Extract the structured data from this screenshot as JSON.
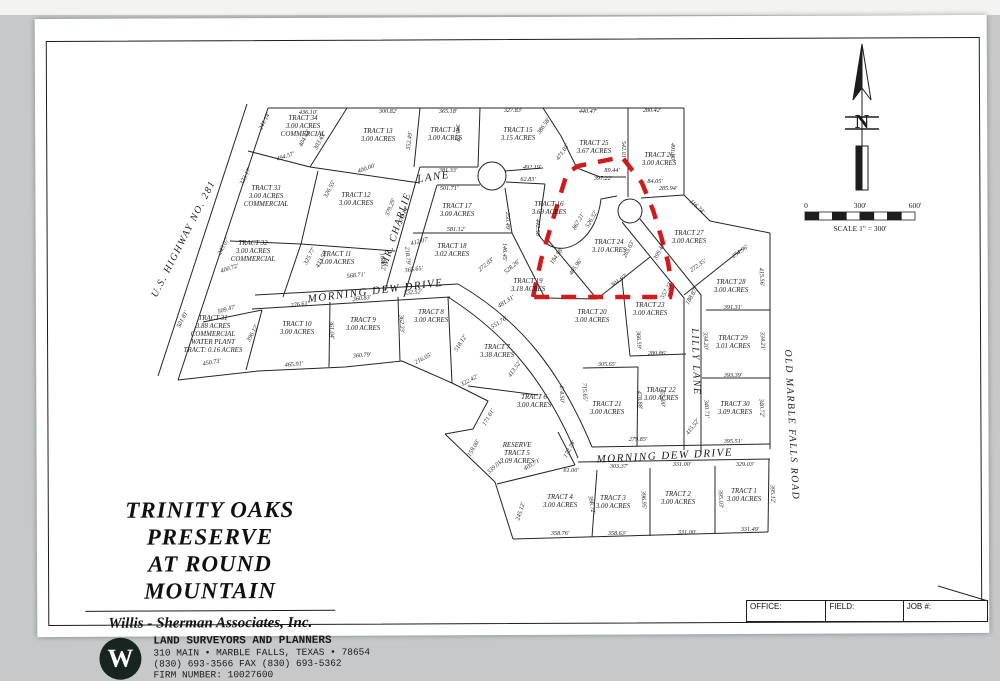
{
  "title_block": {
    "line1": "TRINITY OAKS PRESERVE",
    "line2": "AT ROUND MOUNTAIN",
    "company": "Willis - Sherman Associates, Inc.",
    "tagline": "LAND SURVEYORS AND PLANNERS",
    "address": "310 MAIN • MARBLE FALLS, TEXAS • 78654",
    "phone": "(830) 693-3566   FAX (830) 693-5362",
    "firm": "FIRM NUMBER: 10027600",
    "logo_letter": "W"
  },
  "compass": {
    "north_label": "N"
  },
  "scale_bar": {
    "zero": "0",
    "mid": "300'",
    "end": "600'",
    "caption": "SCALE 1\" = 300'"
  },
  "footer": {
    "cells": [
      {
        "label": "OFFICE:"
      },
      {
        "label": "FIELD:"
      },
      {
        "label": "JOB #:"
      }
    ]
  },
  "map": {
    "highlight_color": "#cf1b1b",
    "roads": [
      {
        "t": "U.S. HIGHWAY NO. 281",
        "x": 186,
        "y": 240,
        "r": -63,
        "fs": 10
      },
      {
        "t": "MR. CHARLIE",
        "x": 399,
        "y": 230,
        "r": -72,
        "fs": 10
      },
      {
        "t": "LANE",
        "x": 434,
        "y": 180,
        "r": -8,
        "fs": 11
      },
      {
        "t": "MORNING DEW DRIVE",
        "x": 376,
        "y": 294,
        "r": -7,
        "fs": 11
      },
      {
        "t": "LILLY LANE",
        "x": 693,
        "y": 362,
        "r": 88,
        "fs": 10
      },
      {
        "t": "OLD MARBLE FALLS ROAD",
        "x": 789,
        "y": 425,
        "r": 87,
        "fs": 10
      },
      {
        "t": "MORNING DEW DRIVE",
        "x": 665,
        "y": 459,
        "r": -3,
        "fs": 11
      }
    ],
    "tracts": [
      {
        "lines": [
          "TRACT 34",
          "3.00 ACRES",
          "COMMERCIAL"
        ],
        "x": 303,
        "y": 120
      },
      {
        "lines": [
          "TRACT 13",
          "3.00 ACRES"
        ],
        "x": 378,
        "y": 133
      },
      {
        "lines": [
          "TRACT 14",
          "3.00 ACRES"
        ],
        "x": 445,
        "y": 132
      },
      {
        "lines": [
          "TRACT 15",
          "3.15 ACRES"
        ],
        "x": 518,
        "y": 132
      },
      {
        "lines": [
          "TRACT 25",
          "3.67 ACRES"
        ],
        "x": 594,
        "y": 145
      },
      {
        "lines": [
          "TRACT 26",
          "3.00 ACRES"
        ],
        "x": 659,
        "y": 157
      },
      {
        "lines": [
          "TRACT 33",
          "3.00 ACRES",
          "COMMERCIAL"
        ],
        "x": 266,
        "y": 190
      },
      {
        "lines": [
          "TRACT 12",
          "3.00 ACRES"
        ],
        "x": 356,
        "y": 197
      },
      {
        "lines": [
          "TRACT 17",
          "3.00 ACRES"
        ],
        "x": 457,
        "y": 208
      },
      {
        "lines": [
          "TRACT 16",
          "3.69 ACRES"
        ],
        "x": 549,
        "y": 206
      },
      {
        "lines": [
          "TRACT 32",
          "3.00 ACRES",
          "COMMERCIAL"
        ],
        "x": 253,
        "y": 245
      },
      {
        "lines": [
          "TRACT 11",
          "3.00 ACRES"
        ],
        "x": 337,
        "y": 256
      },
      {
        "lines": [
          "TRACT 18",
          "3.02 ACRES"
        ],
        "x": 452,
        "y": 248
      },
      {
        "lines": [
          "TRACT 24",
          "3.10 ACRES"
        ],
        "x": 609,
        "y": 244
      },
      {
        "lines": [
          "TRACT 27",
          "3.00 ACRES"
        ],
        "x": 689,
        "y": 235
      },
      {
        "lines": [
          "TRACT 28",
          "3.00 ACRES"
        ],
        "x": 731,
        "y": 284
      },
      {
        "lines": [
          "TRACT 31",
          "3.88 ACRES",
          "COMMERCIAL",
          "WATER PLANT",
          "TRACT: 0.16 ACRES"
        ],
        "x": 213,
        "y": 320
      },
      {
        "lines": [
          "TRACT 10",
          "3.00 ACRES"
        ],
        "x": 297,
        "y": 326
      },
      {
        "lines": [
          "TRACT 9",
          "3.00 ACRES"
        ],
        "x": 363,
        "y": 322
      },
      {
        "lines": [
          "TRACT 8",
          "3.00 ACRES"
        ],
        "x": 431,
        "y": 314
      },
      {
        "lines": [
          "TRACT 19",
          "3.18 ACRES"
        ],
        "x": 528,
        "y": 283
      },
      {
        "lines": [
          "TRACT 20",
          "3.00 ACRES"
        ],
        "x": 592,
        "y": 314
      },
      {
        "lines": [
          "TRACT 23",
          "3.00 ACRES"
        ],
        "x": 650,
        "y": 307
      },
      {
        "lines": [
          "TRACT 7",
          "3.38 ACRES"
        ],
        "x": 497,
        "y": 349
      },
      {
        "lines": [
          "TRACT 29",
          "3.01 ACRES"
        ],
        "x": 733,
        "y": 340
      },
      {
        "lines": [
          "TRACT 6",
          "3.00 ACRES"
        ],
        "x": 534,
        "y": 399
      },
      {
        "lines": [
          "TRACT 21",
          "3.00 ACRES"
        ],
        "x": 607,
        "y": 406
      },
      {
        "lines": [
          "TRACT 22",
          "3.00 ACRES"
        ],
        "x": 661,
        "y": 392
      },
      {
        "lines": [
          "TRACT 30",
          "3.09 ACRES"
        ],
        "x": 735,
        "y": 406
      },
      {
        "lines": [
          "RESERVE",
          "TRACT 5",
          "3.09 ACRES"
        ],
        "x": 517,
        "y": 447
      },
      {
        "lines": [
          "TRACT 4",
          "3.00 ACRES"
        ],
        "x": 560,
        "y": 499
      },
      {
        "lines": [
          "TRACT 3",
          "3.00 ACRES"
        ],
        "x": 613,
        "y": 500
      },
      {
        "lines": [
          "TRACT 2",
          "3.00 ACRES"
        ],
        "x": 678,
        "y": 496
      },
      {
        "lines": [
          "TRACT 1",
          "3.00 ACRES"
        ],
        "x": 744,
        "y": 493
      }
    ],
    "dimensions": [
      {
        "t": "436.10'",
        "x": 308,
        "y": 114
      },
      {
        "t": "300.82'",
        "x": 388,
        "y": 113
      },
      {
        "t": "365.18'",
        "x": 448,
        "y": 113
      },
      {
        "t": "327.83'",
        "x": 513,
        "y": 112
      },
      {
        "t": "440.47'",
        "x": 588,
        "y": 113
      },
      {
        "t": "280.42'",
        "x": 652,
        "y": 112
      },
      {
        "t": "241.14'",
        "x": 266,
        "y": 122,
        "r": -62
      },
      {
        "t": "404.43'",
        "x": 306,
        "y": 139,
        "r": -62
      },
      {
        "t": "303.43'",
        "x": 321,
        "y": 142,
        "r": -62
      },
      {
        "t": "352.49'",
        "x": 411,
        "y": 141,
        "r": -83
      },
      {
        "t": "343.79'",
        "x": 456,
        "y": 133,
        "r": 90
      },
      {
        "t": "386.58'",
        "x": 545,
        "y": 127,
        "r": -55
      },
      {
        "t": "471.03'",
        "x": 564,
        "y": 153,
        "r": -55
      },
      {
        "t": "542.01'",
        "x": 622,
        "y": 150,
        "r": 90
      },
      {
        "t": "491.90'",
        "x": 671,
        "y": 152,
        "r": 90
      },
      {
        "t": "494.57'",
        "x": 286,
        "y": 158,
        "r": -18
      },
      {
        "t": "400.00'",
        "x": 367,
        "y": 170,
        "r": -20
      },
      {
        "t": "381.33'",
        "x": 448,
        "y": 172
      },
      {
        "t": "492.19'",
        "x": 532,
        "y": 169
      },
      {
        "t": "62.83'",
        "x": 528,
        "y": 181
      },
      {
        "t": "89.44'",
        "x": 612,
        "y": 172
      },
      {
        "t": "397.22'",
        "x": 603,
        "y": 180
      },
      {
        "t": "84.05'",
        "x": 655,
        "y": 183
      },
      {
        "t": "285.94'",
        "x": 668,
        "y": 190
      },
      {
        "t": "116.74'",
        "x": 696,
        "y": 208,
        "r": 42
      },
      {
        "t": "323.17'",
        "x": 247,
        "y": 177,
        "r": -62
      },
      {
        "t": "326.55'",
        "x": 331,
        "y": 190,
        "r": -62
      },
      {
        "t": "379.29'",
        "x": 392,
        "y": 208,
        "r": -68
      },
      {
        "t": "270.14'",
        "x": 405,
        "y": 216,
        "r": -68
      },
      {
        "t": "501.71'",
        "x": 449,
        "y": 190
      },
      {
        "t": "250.49'",
        "x": 506,
        "y": 221,
        "r": 90
      },
      {
        "t": "442.58'",
        "x": 536,
        "y": 228,
        "r": 90
      },
      {
        "t": "581.12'",
        "x": 456,
        "y": 231
      },
      {
        "t": "243.07'",
        "x": 225,
        "y": 247,
        "r": -62
      },
      {
        "t": "412.07'",
        "x": 420,
        "y": 243,
        "r": -14
      },
      {
        "t": "325.77'",
        "x": 311,
        "y": 257,
        "r": -62
      },
      {
        "t": "433.59'",
        "x": 323,
        "y": 260,
        "r": -62
      },
      {
        "t": "164.32'",
        "x": 381,
        "y": 262,
        "r": 85
      },
      {
        "t": "218.79'",
        "x": 406,
        "y": 256,
        "r": 85
      },
      {
        "t": "365.65'",
        "x": 414,
        "y": 271,
        "r": -8
      },
      {
        "t": "568.71'",
        "x": 356,
        "y": 277,
        "r": -6
      },
      {
        "t": "272.03'",
        "x": 487,
        "y": 266,
        "r": -40
      },
      {
        "t": "528.26'",
        "x": 513,
        "y": 268,
        "r": -40
      },
      {
        "t": "146.45'",
        "x": 503,
        "y": 252,
        "r": 90
      },
      {
        "t": "194.98'",
        "x": 558,
        "y": 257,
        "r": -55
      },
      {
        "t": "405.96'",
        "x": 577,
        "y": 268,
        "r": -55
      },
      {
        "t": "265.63'",
        "x": 630,
        "y": 250,
        "r": -62
      },
      {
        "t": "399.41'",
        "x": 661,
        "y": 252,
        "r": -62
      },
      {
        "t": "867.21'",
        "x": 580,
        "y": 222,
        "r": -60
      },
      {
        "t": "526.32'",
        "x": 593,
        "y": 220,
        "r": -60
      },
      {
        "t": "301.97'",
        "x": 620,
        "y": 282,
        "r": -35
      },
      {
        "t": "557.27'",
        "x": 668,
        "y": 291,
        "r": -60
      },
      {
        "t": "188.87'",
        "x": 693,
        "y": 297,
        "r": -60
      },
      {
        "t": "272.35'",
        "x": 699,
        "y": 267,
        "r": -35
      },
      {
        "t": "254.96'",
        "x": 741,
        "y": 253,
        "r": -35
      },
      {
        "t": "415.56'",
        "x": 760,
        "y": 277,
        "r": 87
      },
      {
        "t": "391.31'",
        "x": 733,
        "y": 309
      },
      {
        "t": "334.20'",
        "x": 704,
        "y": 341,
        "r": 87
      },
      {
        "t": "334.21'",
        "x": 761,
        "y": 341,
        "r": 87
      },
      {
        "t": "393.39'",
        "x": 733,
        "y": 377
      },
      {
        "t": "340.71'",
        "x": 705,
        "y": 409,
        "r": 87
      },
      {
        "t": "340.72'",
        "x": 760,
        "y": 408,
        "r": 87
      },
      {
        "t": "395.51'",
        "x": 733,
        "y": 443
      },
      {
        "t": "276.61'",
        "x": 300,
        "y": 306,
        "r": -8
      },
      {
        "t": "396.12'",
        "x": 254,
        "y": 334,
        "r": -62
      },
      {
        "t": "361.04'",
        "x": 330,
        "y": 330,
        "r": 87
      },
      {
        "t": "465.91'",
        "x": 294,
        "y": 366,
        "r": -5
      },
      {
        "t": "360.83'",
        "x": 362,
        "y": 300,
        "r": -6
      },
      {
        "t": "360.79'",
        "x": 362,
        "y": 357,
        "r": -5
      },
      {
        "t": "362.23'",
        "x": 400,
        "y": 324,
        "r": 87
      },
      {
        "t": "332.52'",
        "x": 413,
        "y": 294,
        "r": -6
      },
      {
        "t": "216.05'",
        "x": 424,
        "y": 360,
        "r": -28
      },
      {
        "t": "518.12'",
        "x": 462,
        "y": 344,
        "r": -58
      },
      {
        "t": "322.42'",
        "x": 470,
        "y": 382,
        "r": -28
      },
      {
        "t": "413.52'",
        "x": 516,
        "y": 370,
        "r": -55
      },
      {
        "t": "474.50'",
        "x": 560,
        "y": 394,
        "r": 87
      },
      {
        "t": "715.65'",
        "x": 583,
        "y": 392,
        "r": 87
      },
      {
        "t": "305.65'",
        "x": 607,
        "y": 366
      },
      {
        "t": "366.59'",
        "x": 637,
        "y": 340,
        "r": 87
      },
      {
        "t": "280.86'",
        "x": 657,
        "y": 355
      },
      {
        "t": "478.88'",
        "x": 638,
        "y": 400,
        "r": 87
      },
      {
        "t": "455.00'",
        "x": 661,
        "y": 398,
        "r": 87
      },
      {
        "t": "279.85'",
        "x": 638,
        "y": 441
      },
      {
        "t": "481.31'",
        "x": 507,
        "y": 303,
        "r": -33
      },
      {
        "t": "551.76'",
        "x": 500,
        "y": 324,
        "r": -33
      },
      {
        "t": "171.61'",
        "x": 490,
        "y": 418,
        "r": -60
      },
      {
        "t": "159.00'",
        "x": 475,
        "y": 449,
        "r": -60
      },
      {
        "t": "339.01'",
        "x": 496,
        "y": 468,
        "r": -42
      },
      {
        "t": "405.71'",
        "x": 533,
        "y": 466,
        "r": -30
      },
      {
        "t": "172.79'",
        "x": 571,
        "y": 450,
        "r": -60
      },
      {
        "t": "61.00'",
        "x": 571,
        "y": 472
      },
      {
        "t": "303.37'",
        "x": 619,
        "y": 468
      },
      {
        "t": "331.00'",
        "x": 682,
        "y": 466
      },
      {
        "t": "329.03'",
        "x": 745,
        "y": 466
      },
      {
        "t": "398.72'",
        "x": 590,
        "y": 505,
        "r": 80
      },
      {
        "t": "396.95'",
        "x": 642,
        "y": 500,
        "r": 87
      },
      {
        "t": "395.03'",
        "x": 719,
        "y": 499,
        "r": 87
      },
      {
        "t": "395.12'",
        "x": 771,
        "y": 494,
        "r": 87
      },
      {
        "t": "245.12'",
        "x": 522,
        "y": 512,
        "r": -72
      },
      {
        "t": "358.76'",
        "x": 560,
        "y": 535
      },
      {
        "t": "358.63'",
        "x": 617,
        "y": 535
      },
      {
        "t": "331.00'",
        "x": 687,
        "y": 534
      },
      {
        "t": "331.49'",
        "x": 750,
        "y": 531
      },
      {
        "t": "501.81'",
        "x": 184,
        "y": 320,
        "r": -62
      },
      {
        "t": "450.73'",
        "x": 212,
        "y": 364,
        "r": -10
      },
      {
        "t": "509.47'",
        "x": 227,
        "y": 311,
        "r": -16
      },
      {
        "t": "400.72'",
        "x": 230,
        "y": 270,
        "r": -18
      },
      {
        "t": "415.52'",
        "x": 694,
        "y": 428,
        "r": -52
      }
    ]
  }
}
